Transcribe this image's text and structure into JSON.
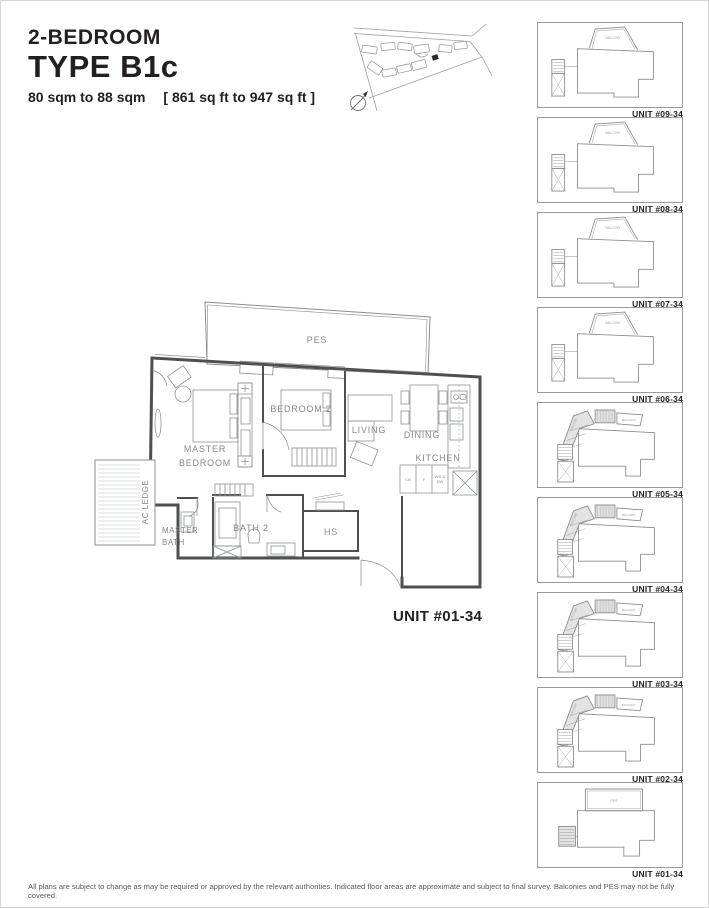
{
  "header": {
    "title_small": "2-BEDROOM",
    "title_large": "TYPE B1c",
    "area_metric": "80 sqm to 88 sqm",
    "area_imperial": "[ 861 sq ft to 947 sq ft ]"
  },
  "main_plan": {
    "unit_label": "UNIT #01-34",
    "rooms": {
      "pes": "PES",
      "master_bedroom_l1": "MASTER",
      "master_bedroom_l2": "BEDROOM",
      "bedroom2": "BEDROOM 2",
      "living": "LIVING",
      "dining": "DINING",
      "kitchen": "KITCHEN",
      "ac_ledge": "AC LEDGE",
      "master_bath_l1": "MASTER",
      "master_bath_l2": "BATH",
      "bath2": "BATH 2",
      "hs": "HS"
    },
    "appliances": {
      "cb": "CB",
      "f": "F",
      "wd_dw_l1": "WD &",
      "wd_dw_l2": "DW"
    }
  },
  "key_plans": {
    "balcony_label": "BALCONY",
    "pes_label": "PES",
    "units": [
      {
        "label": "UNIT #09-34"
      },
      {
        "label": "UNIT #08-34"
      },
      {
        "label": "UNIT #07-34"
      },
      {
        "label": "UNIT #06-34"
      },
      {
        "label": "UNIT #05-34"
      },
      {
        "label": "UNIT #04-34"
      },
      {
        "label": "UNIT #03-34"
      },
      {
        "label": "UNIT #02-34"
      },
      {
        "label": "UNIT #01-34"
      }
    ]
  },
  "footer": {
    "disclaimer": "All plans are subject to change as may be required or approved by the relevant authorities. Indicated floor areas are approximate and subject to final survey. Balconies and PES may not be fully covered."
  },
  "colors": {
    "wall": "#4d4f52",
    "line": "#8a8c8f",
    "label": "#85878a",
    "title": "#231f20",
    "footer_text": "#58595b"
  }
}
